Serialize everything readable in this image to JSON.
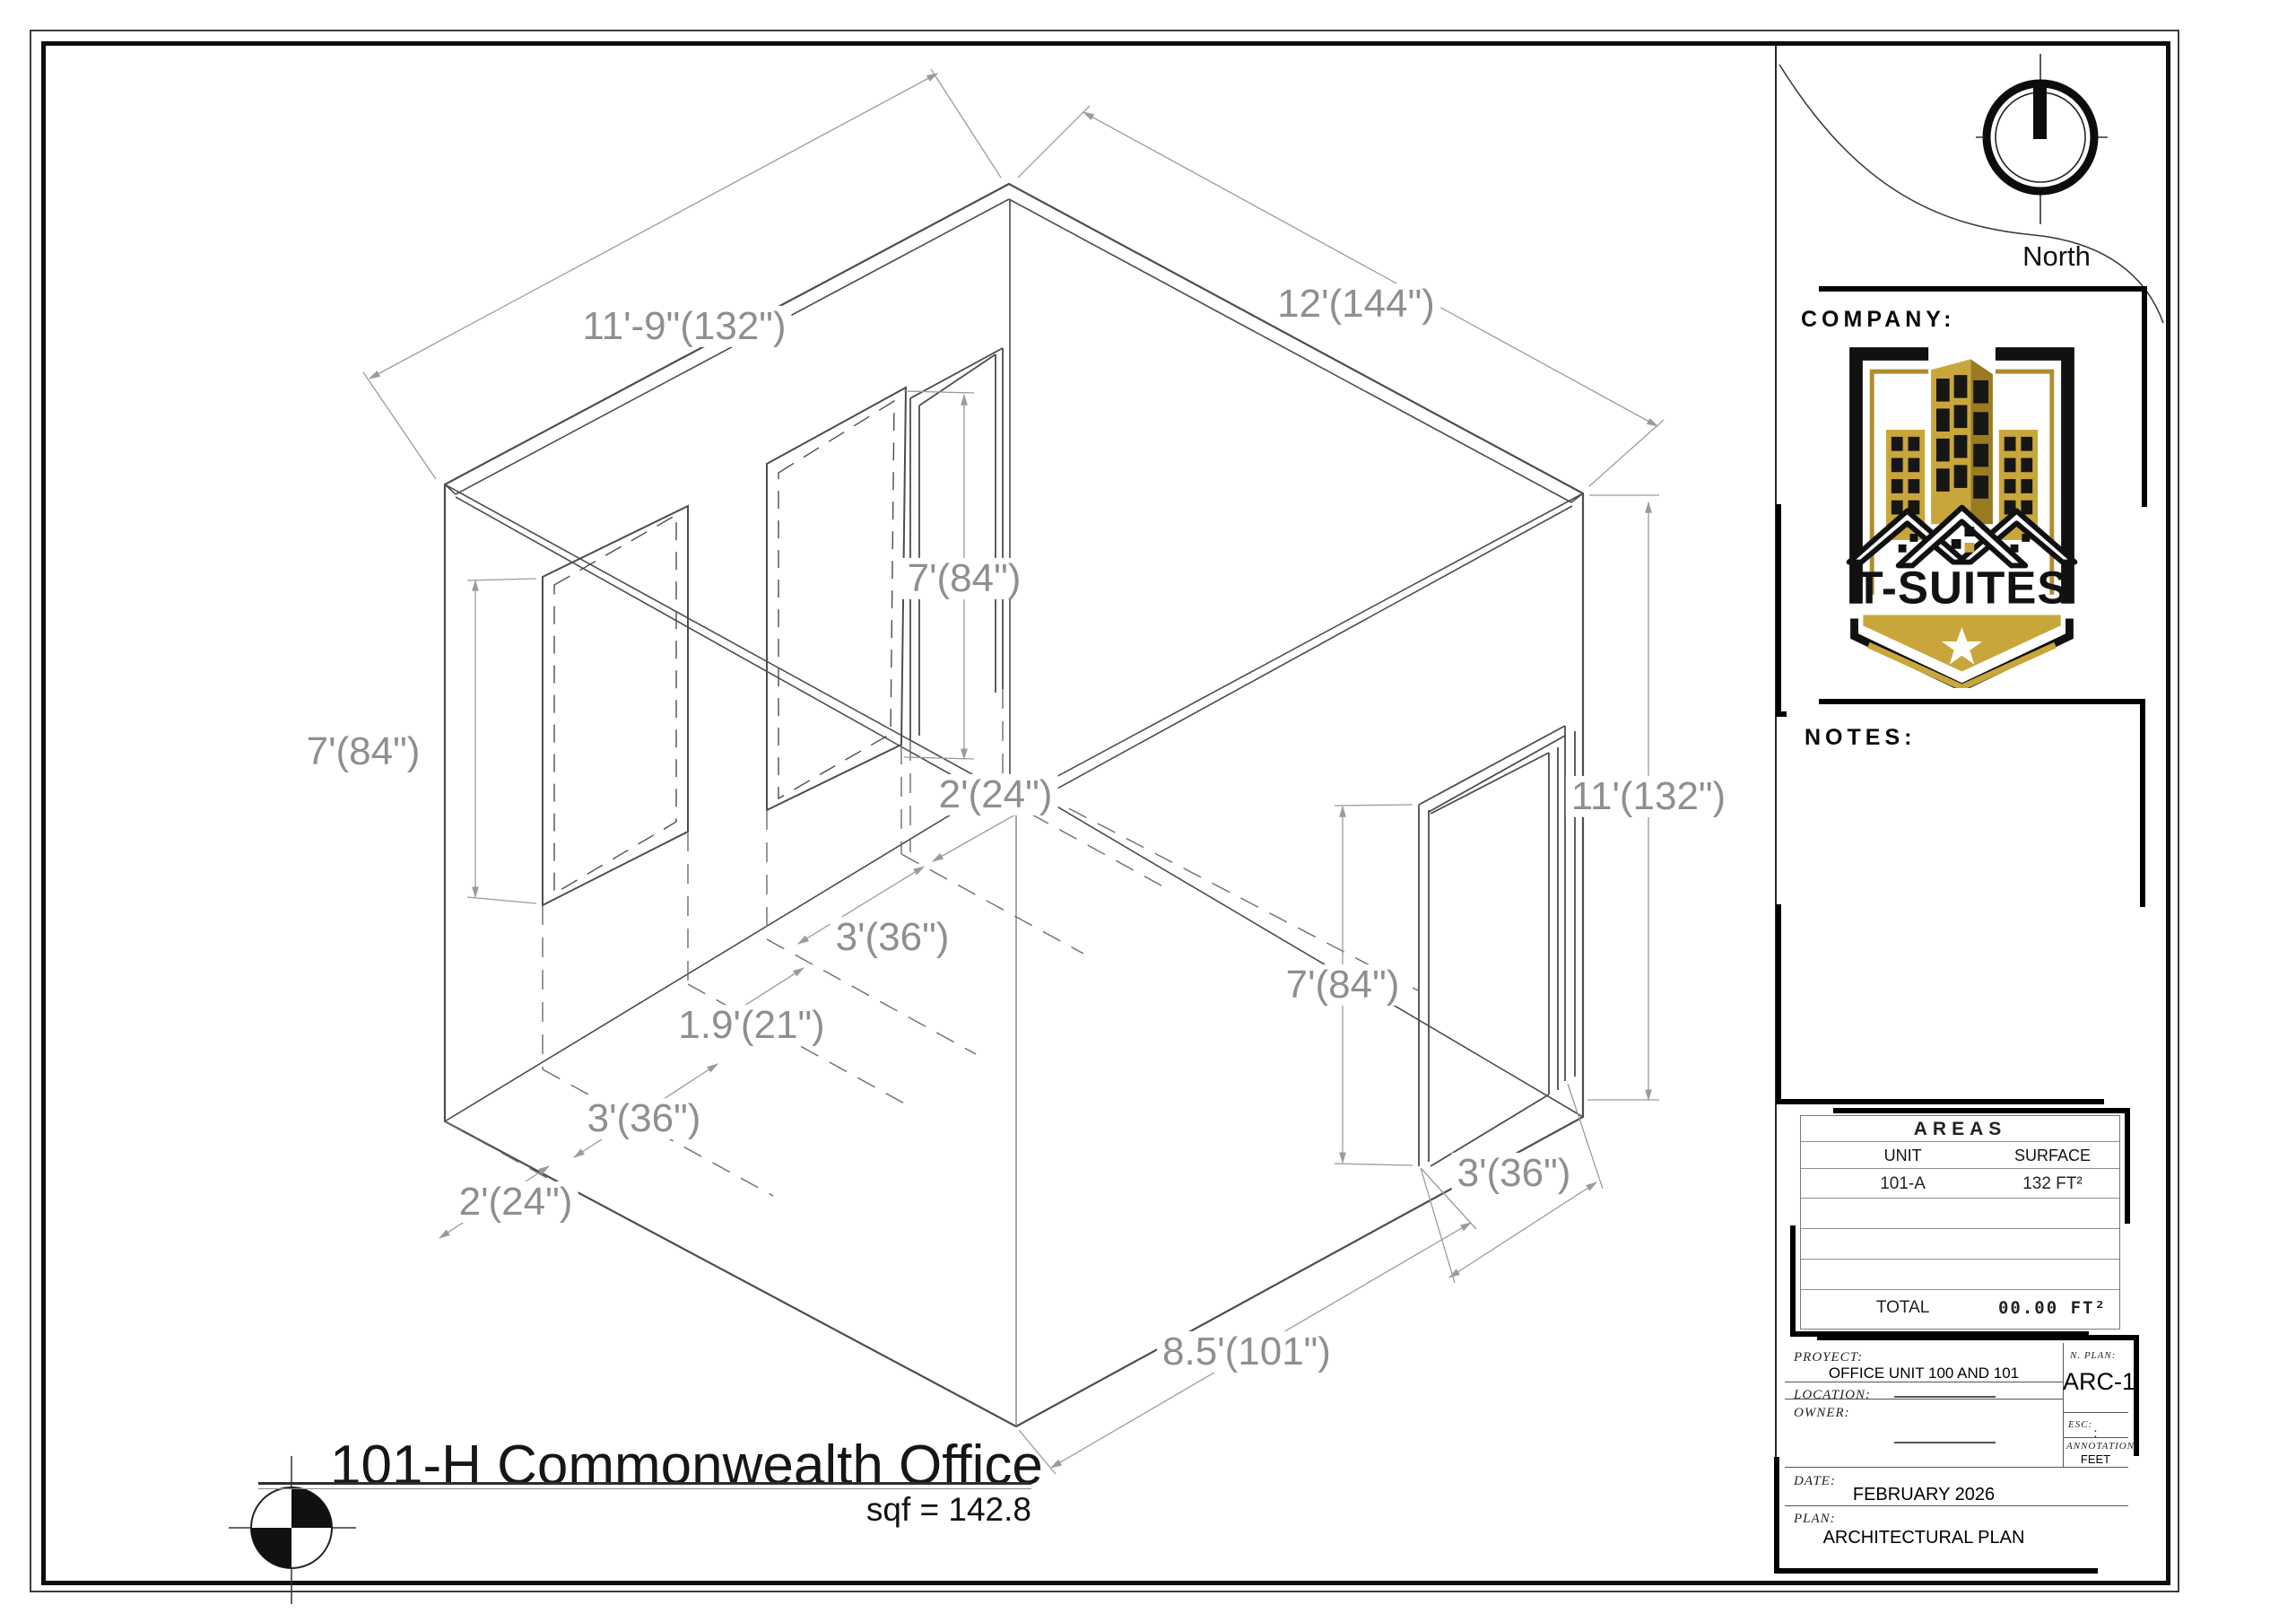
{
  "drawing": {
    "title": "101-H Commonwealth Office",
    "area_text": "sqf = 142.8",
    "dims": {
      "top_left": "11'-9\"(132\")",
      "top_right": "12'(144\")",
      "back_door_height": "7'(84\")",
      "center_door_width": "2'(24\")",
      "center_window_width": "3'(36\")",
      "window_gap": "1.9'(21\")",
      "left_window_width": "3'(36\")",
      "left_end_gap": "2'(24\")",
      "left_window_height": "7'(84\")",
      "right_wall_height": "11'(132\")",
      "front_door_height": "7'(84\")",
      "front_door_width": "3'(36\")",
      "front_wall_length": "8.5'(101\")"
    }
  },
  "sidebar": {
    "north_label": "North",
    "company": {
      "header": "COMPANY:",
      "brand": "T-SUITES"
    },
    "notes": {
      "header": "NOTES:"
    },
    "areas": {
      "title": "AREAS",
      "col_unit": "UNIT",
      "col_surface": "SURFACE",
      "rows": [
        {
          "unit": "101-A",
          "surface": "132 FT²"
        }
      ],
      "total_label": "TOTAL",
      "total_value": "00.00 FT²"
    },
    "project": {
      "proyect_label": "PROYECT:",
      "proyect_value": "OFFICE UNIT 100 AND 101",
      "location_label": "LOCATION:",
      "owner_label": "OWNER:",
      "date_label": "DATE:",
      "date_value": "FEBRUARY 2026",
      "plan_label": "PLAN:",
      "plan_value": "ARCHITECTURAL PLAN",
      "nplan_label": "N. PLAN:",
      "nplan_value": "ARC-1",
      "esc_label": "ESC:",
      "esc_value": ":",
      "annotation_label": "ANNOTATION:",
      "annotation_value": "FEET"
    }
  }
}
